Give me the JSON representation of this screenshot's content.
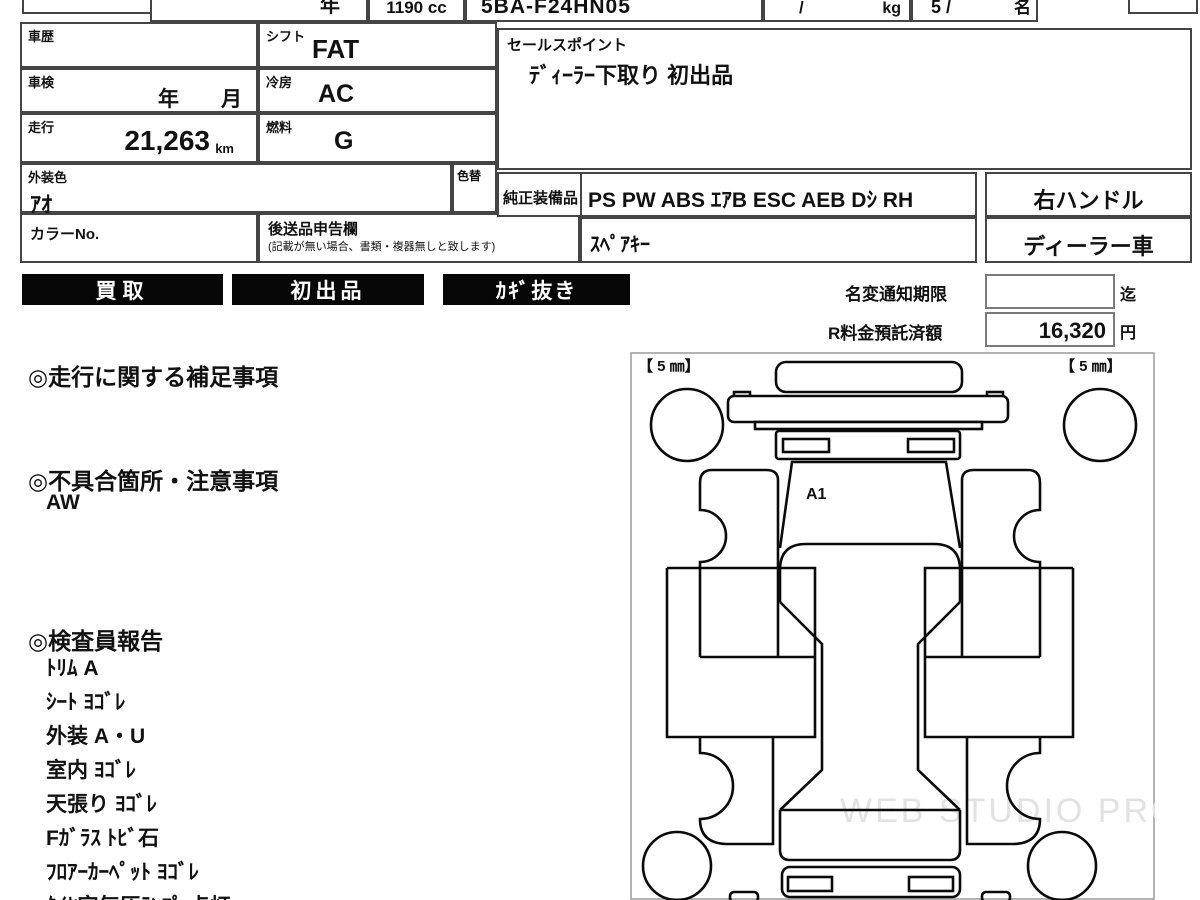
{
  "header_strip": {
    "year_suffix": "年",
    "engine_cc": "1190 cc",
    "model_code": "5BA-F24HN05",
    "weight_slash": "/",
    "weight_unit": "kg",
    "capacity": "5 /",
    "capacity_unit": "名"
  },
  "spec_table": {
    "history_label": "車歴",
    "shift_label": "シフト",
    "shift_value": "FAT",
    "inspection_label": "車検",
    "inspection_value": "年　　月",
    "aircon_label": "冷房",
    "aircon_value": "AC",
    "mileage_label": "走行",
    "mileage_value": "21,263",
    "mileage_unit": "km",
    "fuel_label": "燃料",
    "fuel_value": "G",
    "exterior_color_label": "外装色",
    "exterior_color_value": "ｱｵ",
    "color_change_label": "色替",
    "color_no_label": "カラーNo.",
    "later_items_label": "後送品申告欄",
    "later_items_note": "(記載が無い場合、書類・複器無しと致します)"
  },
  "sales_point": {
    "label": "セールスポイント",
    "value": "ﾃﾞｨｰﾗｰ下取り 初出品"
  },
  "equipment": {
    "label": "純正装備品",
    "items": "PS PW ABS ｴｱB ESC AEB Dｼ RH",
    "spare_key": "ｽﾍﾟｱｷｰ",
    "handle": "右ハンドル",
    "dealer_car": "ディーラー車"
  },
  "badges": [
    "買取",
    "初出品",
    "ｶｷﾞ抜き"
  ],
  "notice": {
    "name_change_label": "名変通知期限",
    "name_change_until": "迄",
    "deposit_label": "R料金預託済額",
    "deposit_value": "16,320",
    "deposit_unit": "円"
  },
  "notes": {
    "mileage_note_title": "◎走行に関する補足事項",
    "defect_title": "◎不具合箇所・注意事項",
    "defect_value": "AW",
    "inspector_title": "◎検査員報告",
    "inspector_items": [
      "ﾄﾘﾑ A",
      "ｼｰﾄ ﾖｺﾞﾚ",
      "外装 A・U",
      "室内 ﾖｺﾞﾚ",
      "天張り ﾖｺﾞﾚ",
      "Fｶﾞﾗｽ ﾄﾋﾞ石",
      "ﾌﾛｱｰｶｰﾍﾟｯﾄ ﾖｺﾞﾚ",
      "ﾀｲﾔ空気圧ﾗﾝﾌﾟ 点灯"
    ]
  },
  "diagram": {
    "tread_front_left": "【 5 ㎜】",
    "tread_front_right": "【 5 ㎜】",
    "damage_mark": "A1",
    "watermark": "WEB STUDIO PRO"
  }
}
